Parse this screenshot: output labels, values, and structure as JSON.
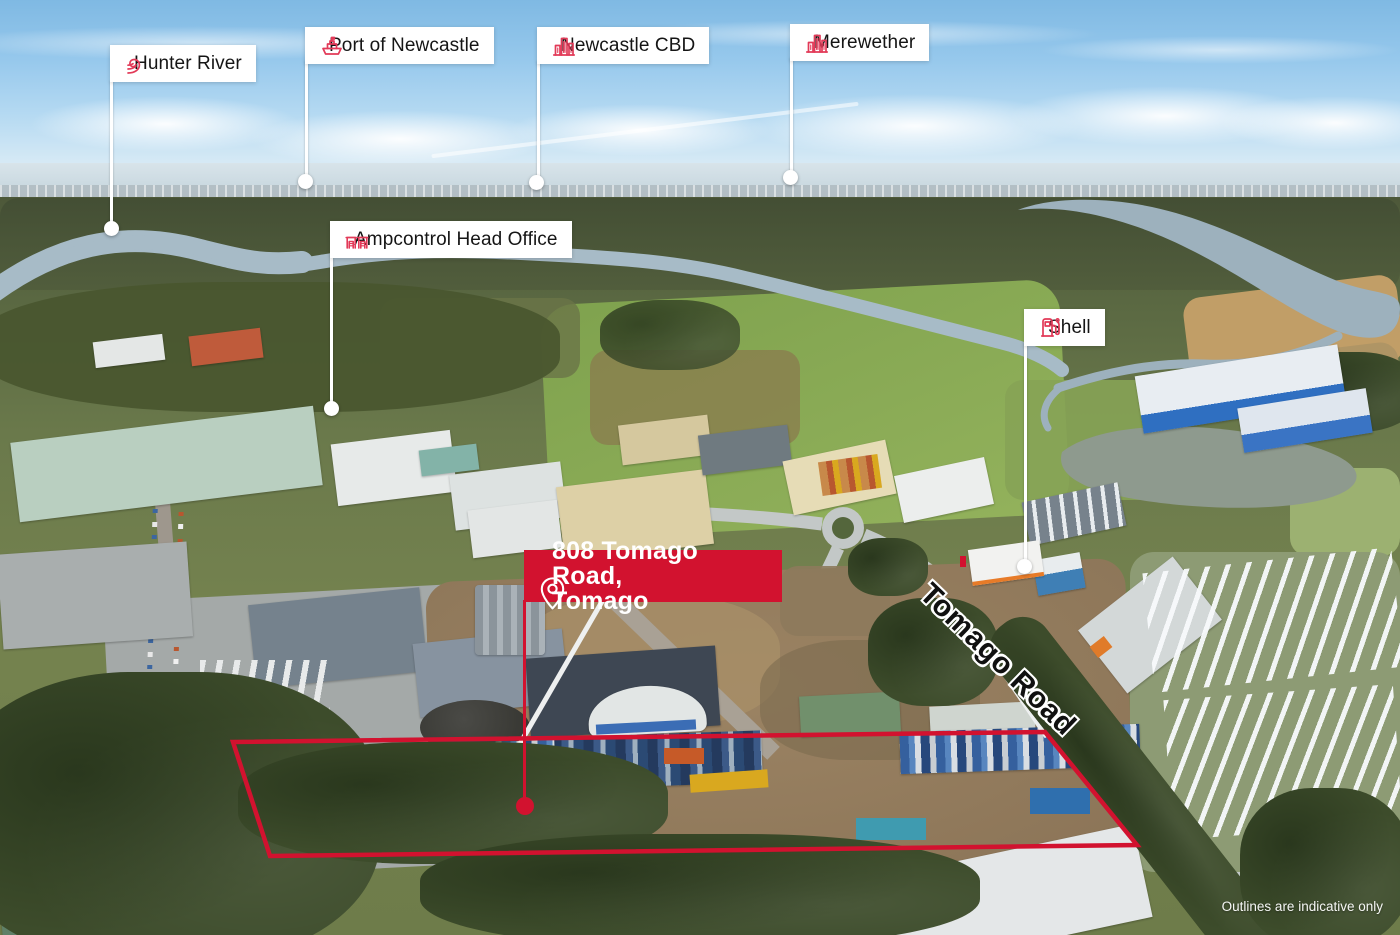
{
  "annotations": {
    "labels": [
      {
        "id": "hunter-river",
        "icon": "wave-icon",
        "text": "Hunter River"
      },
      {
        "id": "port-of-newcastle",
        "icon": "ship-icon",
        "text": "Port of Newcastle"
      },
      {
        "id": "newcastle-cbd",
        "icon": "city-buildings-icon",
        "text": "Newcastle CBD"
      },
      {
        "id": "merewether",
        "icon": "city-buildings-icon",
        "text": "Merewether"
      },
      {
        "id": "ampcontrol",
        "icon": "factory-icon",
        "text": "Ampcontrol Head Office"
      },
      {
        "id": "shell",
        "icon": "fuel-pump-icon",
        "text": "Shell"
      }
    ],
    "property_badge": {
      "icon": "location-pin-icon",
      "line1": "808 Tomago Road,",
      "line2": "Tomago"
    },
    "road_label": "Tomago Road",
    "disclaimer": "Outlines are indicative only"
  },
  "colors": {
    "brand_red": "#D2122F",
    "icon_red": "#E23A58",
    "label_background": "#FFFFFF",
    "label_text": "#151515",
    "leader_line": "#FFFFFF"
  }
}
